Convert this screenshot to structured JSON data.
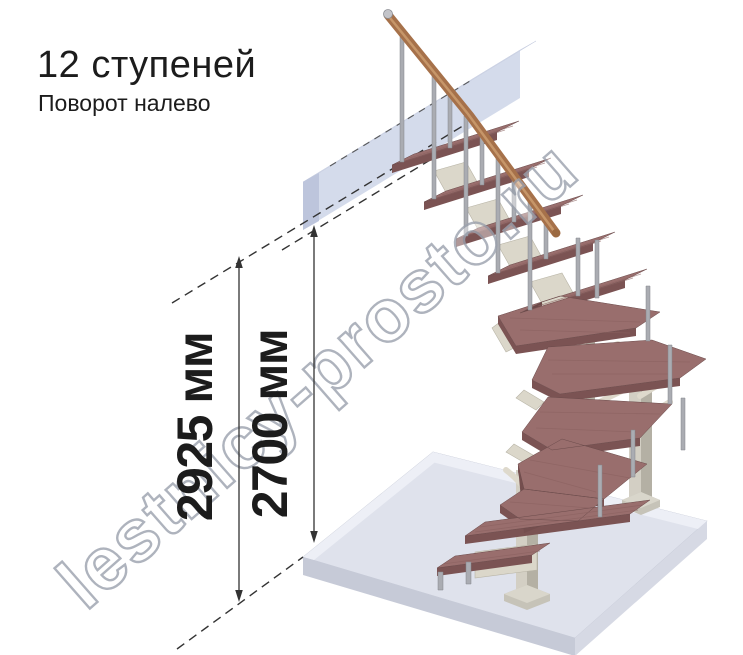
{
  "page": {
    "background": "#ffffff"
  },
  "header": {
    "title": "12 ступеней",
    "subtitle": "Поворот налево"
  },
  "dimensions": [
    {
      "label": "2925 мм"
    },
    {
      "label": "2700 мм"
    }
  ],
  "watermark": {
    "text": "lestnicy-prosto.ru"
  },
  "scene": {
    "steps_shown": 12
  },
  "colors": {
    "text": "#1c1c1c",
    "dimension": "#333333",
    "tread_top": "#996e6d",
    "tread_front": "#7b5353",
    "tread_end": "#6b4848",
    "tread_face_dark": "#744e4e",
    "handrail": "#a6714a",
    "handrail_highlight": "#cb9c6e",
    "metal": "#aaacb2",
    "column_light": "#d3cfc4",
    "column_dark": "#b4b0a4",
    "bracket": "#dbd7ca",
    "platform": "#cbd3e7",
    "floor_top": "#dfe2ec",
    "watermark_outline": "#9ba1ad"
  }
}
